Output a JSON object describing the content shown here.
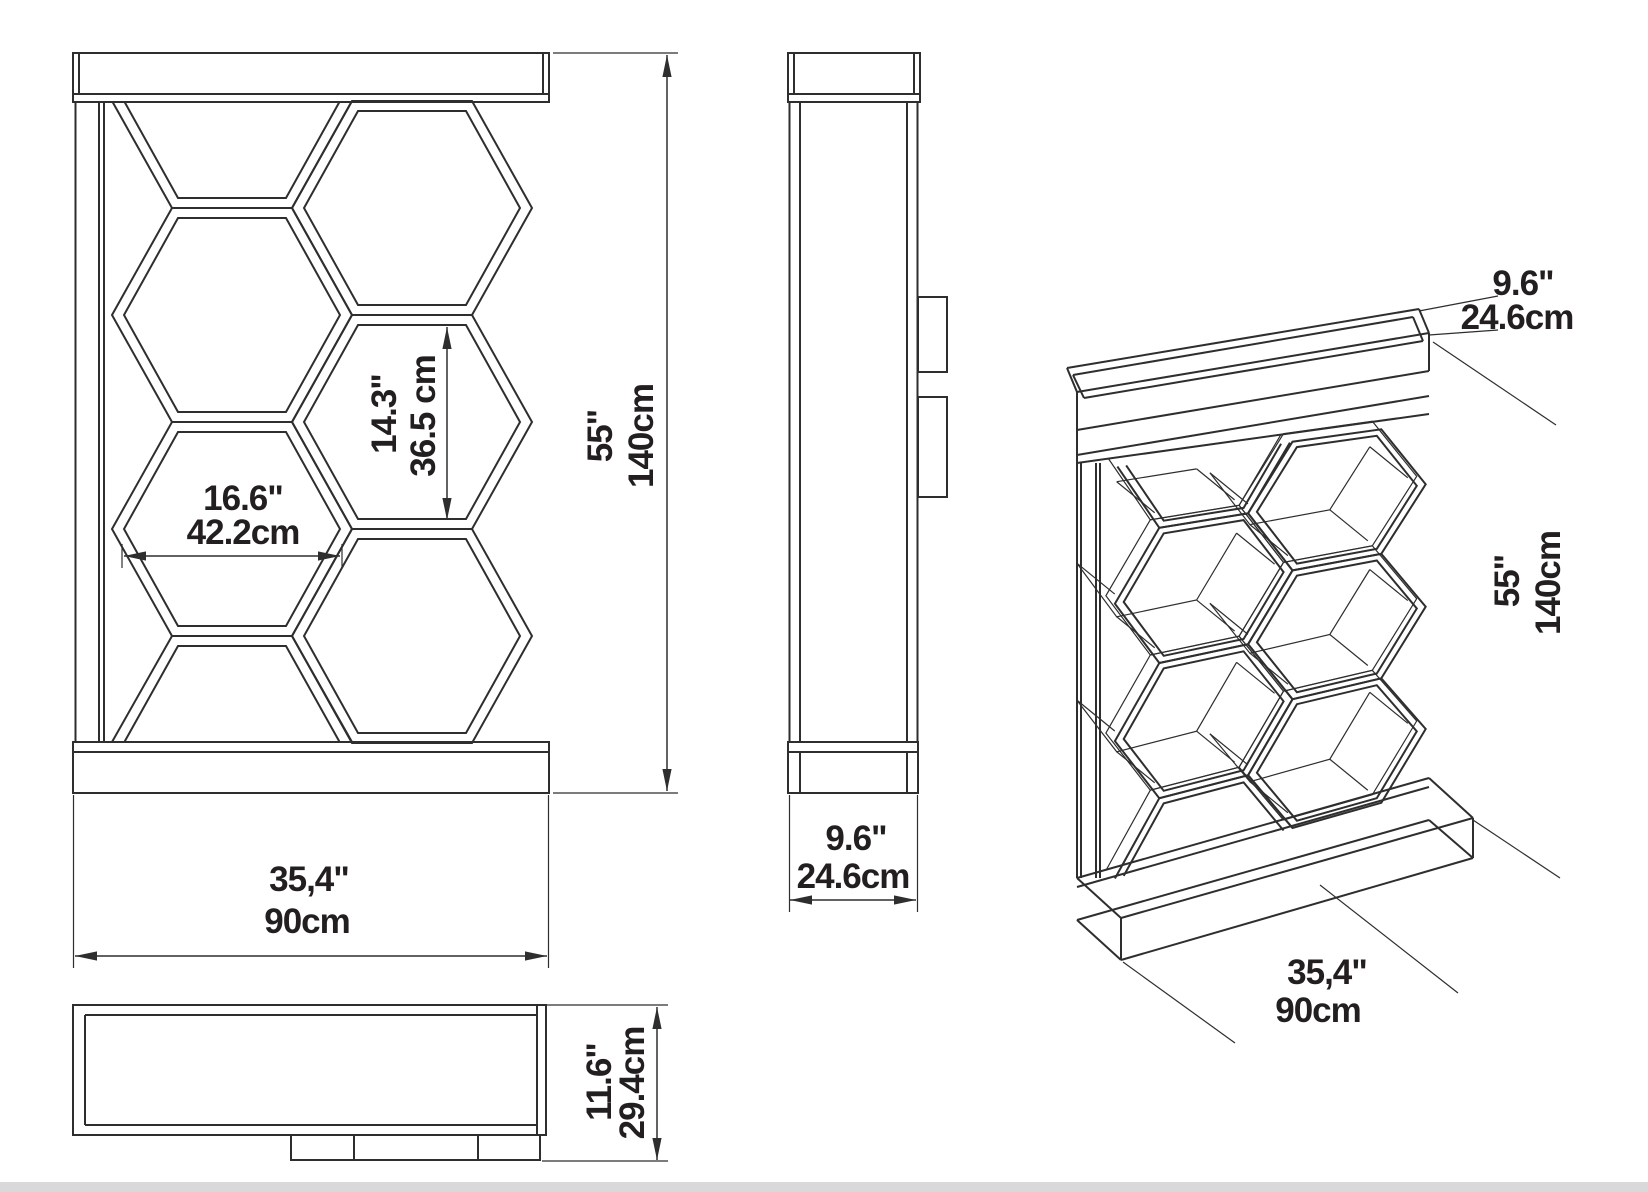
{
  "page": {
    "type": "furniture-technical-drawing",
    "subject": "honeycomb hexagon shelf unit - orthographic and perspective views",
    "colors": {
      "line": "#2e2e2e",
      "text": "#231f20",
      "background": "#ffffff",
      "bottom_strip": "#d9d9d9"
    }
  },
  "views": {
    "front": {
      "labels": {
        "cell_width_in": "16.6\"",
        "cell_width_cm": "42.2cm",
        "cell_height_in": "14.3\"",
        "cell_height_cm": "36.5 cm",
        "height_in": "55\"",
        "height_cm": "140cm",
        "width_in": "35,4\"",
        "width_cm": "90cm"
      }
    },
    "side": {
      "labels": {
        "depth_in": "9.6\"",
        "depth_cm": "24.6cm"
      }
    },
    "top": {
      "labels": {
        "depth_in": "11.6\"",
        "depth_cm": "29.4cm"
      }
    },
    "isometric": {
      "labels": {
        "tray_depth_in": "9.6\"",
        "tray_depth_cm": "24.6cm",
        "height_in": "55\"",
        "height_cm": "140cm",
        "width_in": "35,4\"",
        "width_cm": "90cm"
      }
    }
  }
}
